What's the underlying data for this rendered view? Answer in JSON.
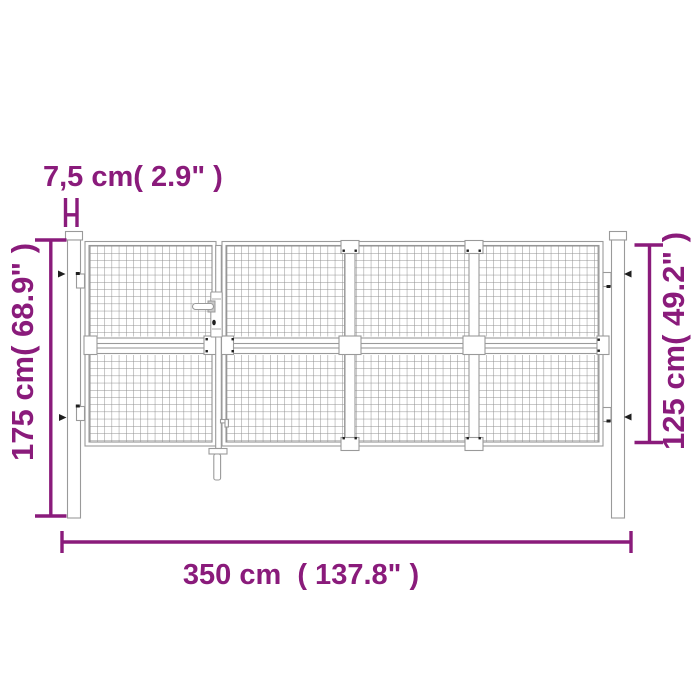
{
  "diagram": {
    "type": "product-dimension-diagram",
    "subject": "garden gate with wire mesh and two posts",
    "colors": {
      "accent": "#8A1B7B",
      "outline": "#9A9A9A",
      "mesh": "#8F8F8F",
      "dark_mark": "#1F1F1F",
      "bg": "#FFFFFF"
    },
    "labels": {
      "post_width": "7,5 cm( 2.9\" )",
      "post_height": "175 cm( 68.9\" )",
      "leaf_height": "125 cm( 49.2\" )",
      "total_width": "350 cm  ( 137.8\" )"
    },
    "measurements": {
      "post_width_cm": "7,5",
      "post_width_in": "2.9",
      "post_height_cm": "175",
      "post_height_in": "68.9",
      "leaf_height_cm": "125",
      "leaf_height_in": "49.2",
      "total_width_cm": "350",
      "total_width_in": "137.8"
    }
  }
}
